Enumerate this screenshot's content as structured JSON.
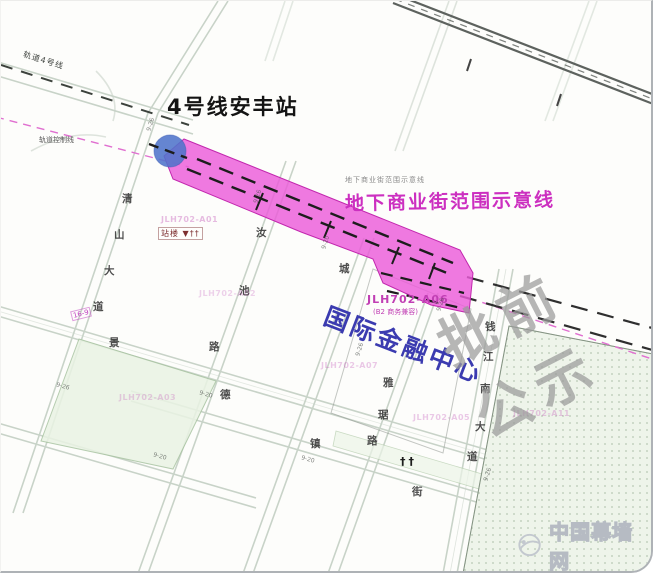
{
  "colors": {
    "corridor_fill": "#ec5bd9",
    "corridor_label": "#cc2fc0",
    "station_marker": "#5074cb",
    "ifc_title": "#3b3bb0",
    "watermark_gray": "#9a9a9a",
    "control_line_pink": "#e06fd0"
  },
  "station": {
    "title": "4号线安丰站",
    "note": "站楼 ▼††"
  },
  "corridor": {
    "label": "地下商业街范围示意线",
    "note": "地下商业街范围示意线"
  },
  "center": {
    "name": "国际金融中心",
    "parcel_code": "JLH702-A06",
    "parcel_use": "(B2 商务兼容)"
  },
  "rail": {
    "line_label": "轨道4号线",
    "control_label": "轨道控制线"
  },
  "icons": {
    "trees": "††",
    "mini_tag": "16-9"
  },
  "watermarks": {
    "diagonal_text": "批前公示",
    "site_text": "中国幕墙网"
  },
  "road_names": [
    {
      "text": "清",
      "x": 121,
      "y": 190
    },
    {
      "text": "山",
      "x": 113,
      "y": 226
    },
    {
      "text": "大",
      "x": 103,
      "y": 262
    },
    {
      "text": "道",
      "x": 92,
      "y": 298
    },
    {
      "text": "景",
      "x": 108,
      "y": 334
    },
    {
      "text": "汝",
      "x": 255,
      "y": 224
    },
    {
      "text": "池",
      "x": 238,
      "y": 282
    },
    {
      "text": "路",
      "x": 208,
      "y": 338
    },
    {
      "text": "城",
      "x": 338,
      "y": 260
    },
    {
      "text": "德",
      "x": 219,
      "y": 386
    },
    {
      "text": "镇",
      "x": 309,
      "y": 435
    },
    {
      "text": "雅",
      "x": 382,
      "y": 374
    },
    {
      "text": "琚",
      "x": 377,
      "y": 406
    },
    {
      "text": "路",
      "x": 366,
      "y": 432
    },
    {
      "text": "街",
      "x": 411,
      "y": 483
    },
    {
      "text": "钱",
      "x": 484,
      "y": 318
    },
    {
      "text": "江",
      "x": 482,
      "y": 348
    },
    {
      "text": "南",
      "x": 479,
      "y": 380
    },
    {
      "text": "大",
      "x": 474,
      "y": 418
    },
    {
      "text": "道",
      "x": 466,
      "y": 448
    }
  ],
  "parcel_codes": [
    {
      "text": "JLH702-A01",
      "x": 160,
      "y": 214,
      "op": 0.38
    },
    {
      "text": "JLH702-A02",
      "x": 198,
      "y": 288,
      "op": 0.25
    },
    {
      "text": "JLH702-A03",
      "x": 118,
      "y": 392,
      "op": 0.28
    },
    {
      "text": "JLH702-A07",
      "x": 320,
      "y": 360,
      "op": 0.3
    },
    {
      "text": "JLH702-A05",
      "x": 412,
      "y": 412,
      "op": 0.3
    },
    {
      "text": "JLH702-A11",
      "x": 512,
      "y": 408,
      "op": 0.3
    }
  ],
  "width_marks": [
    {
      "text": "9-26",
      "x": 143,
      "y": 120,
      "rot": -72
    },
    {
      "text": "9-26",
      "x": 250,
      "y": 192,
      "rot": -72
    },
    {
      "text": "9-20",
      "x": 318,
      "y": 238,
      "rot": -72
    },
    {
      "text": "9-26",
      "x": 433,
      "y": 300,
      "rot": -72
    },
    {
      "text": "9-26",
      "x": 55,
      "y": 382,
      "rot": 16
    },
    {
      "text": "9-20",
      "x": 198,
      "y": 390,
      "rot": 16
    },
    {
      "text": "9-26",
      "x": 352,
      "y": 345,
      "rot": -72
    },
    {
      "text": "9-20",
      "x": 300,
      "y": 455,
      "rot": 16
    },
    {
      "text": "9-26",
      "x": 480,
      "y": 470,
      "rot": -72
    },
    {
      "text": "9-20",
      "x": 152,
      "y": 452,
      "rot": 16
    }
  ]
}
